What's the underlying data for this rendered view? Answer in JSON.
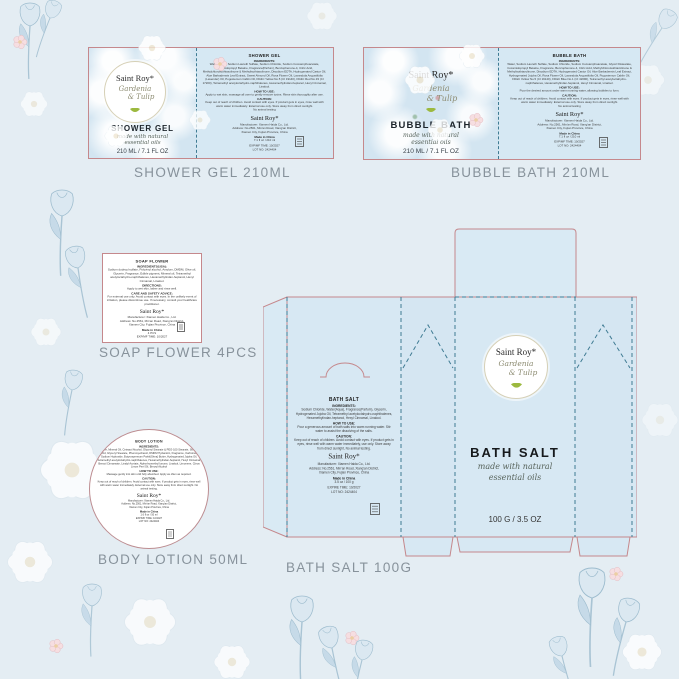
{
  "brand": {
    "name": "Saint Roy*",
    "scent_line1": "Gardenia",
    "scent_line2": "& Tulip",
    "tagline_line1": "made with natural",
    "tagline_line2": "essential oils"
  },
  "captions": {
    "shower_gel": "SHOWER GEL  210ML",
    "bubble_bath": "BUBBLE BATH 210ML",
    "soap_flower": "SOAP FLOWER 4PCS",
    "body_lotion": "BODY LOTION 50ML",
    "bath_salt": "BATH SALT  100G"
  },
  "icons": {
    "leaf": "green-leaf",
    "certification": "recycle-box"
  },
  "colors": {
    "cut_line": "#c5888c",
    "fold_line": "#3f7b93",
    "panel_blue": "#d6e8f3",
    "caption_gray": "#87929b",
    "leaf_green": "#9cb93f"
  },
  "shower_gel": {
    "front": {
      "brand": "Saint Roy*",
      "scent_line1": "Gardenia",
      "scent_line2": "& Tulip",
      "product": "SHOWER GEL",
      "tagline_line1": "made with natural",
      "tagline_line2": "essential oils",
      "size": "210 ML / 7.1 FL OZ"
    },
    "back": {
      "title": "SHOWER GEL",
      "ingredients_label": "INGREDIENTS:",
      "ingredients": "Water(Aqua), Sodium Laureth Sulfate, Sodium Chloride, Sodium Cocoamphoacetate, Cocamidopropyl Betaine, Fragrance(Parfum), Benzophenone-4, Citric Acid, Methylchloroisothiazolinone & Methylisothiazolinone, Disodium EDTA, Hydrogenated Castor Oil, Aloe Barbadensis Leaf Extract, Sweet Almond Oil, Rosa Flower Oil, Lavandula Angustifolia (Lavender) Oil, Pogostemon Cablin Oil, FD&C Yellow No.5 (CI 19140), FD&C Red No.33 (CI 17200), Tetramethyl acetyloctahydro-naphthalenes, Hexamethylindan-heptanol, Hexyl Cinnamal, Linalool.",
      "how_label": "HOW TO USE:",
      "how": "Apply to wet skin, massage all over to gently remove toxins. Rinse skin thoroughly after use.",
      "caution_label": "CAUTION:",
      "caution": "Keep out of reach of children. Avoid contact with eyes. If product gets in eyes, rinse well with warm water immediately. External use only. Store away from direct sunlight.",
      "no_testing": "No animal testing",
      "brand": "Saint Roy*",
      "manufacturer": "Manufacturer: Xiamen Haida Co., Ltd.",
      "address1": "Address: No.2561, Min'an Road, Xiang'an District,",
      "address2": "Xiamen City, Fujian Province, China",
      "made_in": "Made in China",
      "net": "7.1 fl oz / 210 ml",
      "exp": "EXP/MF TIME: 10/2027",
      "lot": "LOT NO: 2424404"
    }
  },
  "bubble_bath": {
    "front": {
      "brand": "Saint Roy*",
      "scent_line1": "Gardenia",
      "scent_line2": "& Tulip",
      "product": "BUBBLE BATH",
      "tagline_line1": "made with natural",
      "tagline_line2": "essential oils",
      "size": "210 ML / 7.1 FL OZ"
    },
    "back": {
      "title": "BUBBLE BATH",
      "ingredients_label": "INGREDIENTS:",
      "ingredients": "Water, Sodium Laureth Sulfate, Sodium Chloride, Sodium Cocoamphoacetate, Glycol Distearate, Cocamidopropyl Betaine, Fragrance, Benzophenone-4, Citric Acid, Methylchloroisothiazolinone & Methylisothiazolinone, Disodium EDTA, Hydrogenated Castor Oil, Aloe Barbadensis Leaf Extract, Hydrogenated Jojoba Oil, Rosa Flower Oil, Lavandula Angustifolia Oil, Pogostemon Cablin Oil, FD&C Yellow No.5 (CI 19140), FD&C Blue No.1 (CI 42090), Tetramethyl acetyloctahydro-naphthalenes, Hexamethylindan-heptanol, Hexyl Cinnamal, Linalool.",
      "how_label": "HOW TO USE:",
      "how": "Pour the desired amount under warm running water, allowing bubbles to form.",
      "caution_label": "CAUTION:",
      "caution": "Keep out of reach of children. Avoid contact with eyes. If product gets in eyes, rinse well with warm water immediately. External use only. Store away from direct sunlight.",
      "no_testing": "No animal testing",
      "brand": "Saint Roy*",
      "manufacturer": "Manufacturer: Xiamen Haida Co., Ltd.",
      "address1": "Address: No.2561, Min'an Road, Xiang'an District,",
      "address2": "Xiamen City, Fujian Province, China",
      "made_in": "Made in China",
      "net": "7.1 fl oz / 210 ml",
      "exp": "EXP/MF TIME: 10/2027",
      "lot": "LOT NO: 2424404"
    }
  },
  "soap_flower": {
    "title": "SOAP FLOWER",
    "ingredients_label": "INGREDIENTS(USA):",
    "ingredients": "Sodium dodecyl sulfate, Polyvinyl alcohol, Amylum, DMDM, Olive oil, Glycerin, Fragrance, Edible pigment, Mineral oil, Tetramethyl acetyloctahydro-naphthalenes, Hexamethylindan-heptanol, Hexyl Cinnamal, Linalool.",
    "directions_label": "DIRECTIONS:",
    "directions": "Apply to wet skin, lather and rinse well.",
    "care_label": "CARE AND SAFETY ADVICE:",
    "care": "For external use only. Avoid contact with eyes. In the unlikely event of irritation, please discontinue use. If necessary, consult your healthcare practitioner.",
    "brand": "Saint Roy*",
    "manufacturer": "Manufacturer: Xiamen Haida Co., Ltd.",
    "address1": "Address: No.2561, Min'an Road, Xiang'an District,",
    "address2": "Xiamen City, Fujian Province, China",
    "made_in": "Made in China",
    "net": "4 PCS",
    "exp": "EXP/MF TIME: 10/2027",
    "lot": "LOT NO: 2424404"
  },
  "body_lotion": {
    "title": "BODY LOTION",
    "ingredients_label": "INGREDIENTS:",
    "ingredients": "Water, Mineral Oil, Cetearyl Alcohol, Glyceryl Stearate & PEG-100 Stearate, Stearic Acid, Glyceryl Stearate, Phenoxyethanol, DMDM Hydantoin, Fragrance, Carbomer, Sodium Hydroxide, Butyrospermum Parkii(Shea) Butter, Hydrogenated Jojoba Oil, Tetramethyl acetyloctahydro-naphthalenes, Hexamethylindan-heptanol, Hexyl Cinnamal, Benzyl Cinnamate, Linalyl Acetate, Alpha-Isomethyl Ionone, Linalool, Limonene, Citrus Limon Peel Oil, Benzyl Alcohol",
    "how_label": "HOW TO USE:",
    "how": "Massage gently into skin until fully absorbed. Apply as often as required.",
    "caution_label": "CAUTION:",
    "caution": "Keep out of reach of children. Avoid contact with eyes. If product gets in eyes, rinse well with warm water immediately. External use only. Store away from direct sunlight. No animal testing.",
    "brand": "Saint Roy*",
    "manufacturer": "Manufacturer: Xiamen Haida Co., Ltd.",
    "address1": "Address: No.2561, Min'an Road, Xiang'an District,",
    "address2": "Xiamen City, Fujian Province, China",
    "made_in": "Made in China",
    "net": "1.6 fl oz / 50 ml",
    "exp": "EXP/MF TIME: 10/2027",
    "lot": "LOT NO: 2424404"
  },
  "bath_salt": {
    "front": {
      "brand": "Saint Roy*",
      "scent_line1": "Gardenia",
      "scent_line2": "& Tulip",
      "product": "BATH SALT",
      "tagline_line1": "made with natural",
      "tagline_line2": "essential oils",
      "size": "100 G / 3.5 OZ"
    },
    "back": {
      "title": "BATH SALT",
      "ingredients_label": "INGREDIENTS:",
      "ingredients": "Sodium Chloride, Water(Aqua), Fragrance(Parfum), Glycerin, Hydrogenated Jojoba Oil, Tetramethyl acetyloctahydro-naphthalenes, Hexamethylindan-heptanol, Hexyl Cinnamal, Linalool.",
      "how_label": "HOW TO USE:",
      "how": "Pour a generous amount of bath salts into warm running water. Stir water to assist the dissolving of the salts.",
      "caution_label": "CAUTION:",
      "caution": "Keep out of reach of children. Avoid contact with eyes. If product gets in eyes, rinse well with warm water immediately, use only. Store away from direct sunlight, No animal testing.",
      "brand": "Saint Roy*",
      "manufacturer": "Manufacturer: Xiamen Haida Co., Ltd.",
      "address1": "Address: No.2561, Min'an Road, Xiang'an District,",
      "address2": "Xiamen City, Fujian Province, China",
      "made_in": "Made in China",
      "net": "3.5 oz / 100 g",
      "exp": "EXPIRE TIME: 10/2027",
      "lot": "LOT NO: 2424404"
    }
  }
}
